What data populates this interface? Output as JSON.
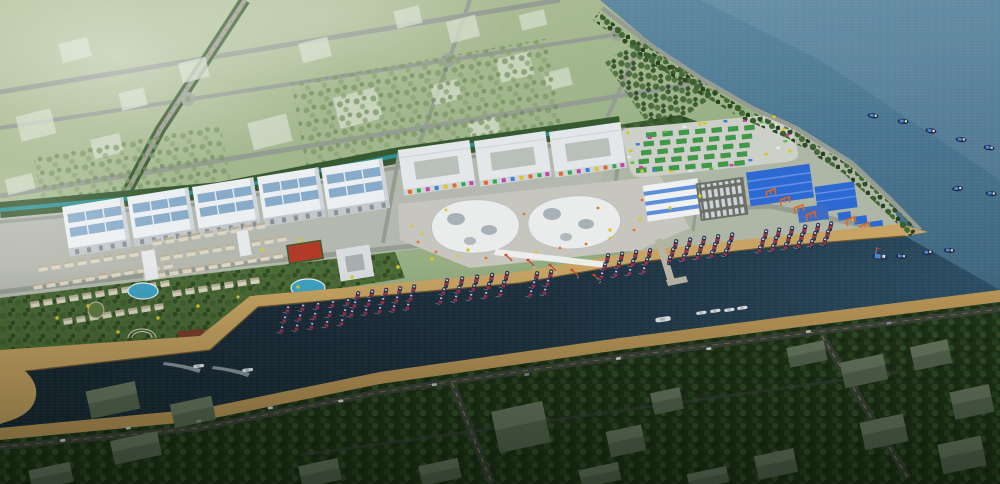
{
  "scene": {
    "description": "Aerial architectural rendering of a coastal fishing-port masterplan: pale green field blocks with grid roads upper-left, a waterfront development strip (white warehouses, white flat commercial blocks, two organic white membrane halls, a pale market lot with green stalls, blue-roofed market sheds with orange gantry cranes, a villa resort with pools), a dark harbor channel lined with tan quays and clusters of moored fishing boats, open steel-blue sea upper-right with scattered fishing boats, and a dark tree-filled district across the channel at the bottom."
  },
  "palette": {
    "sea1": "#6590a6",
    "sea2": "#4a7590",
    "sea3": "#3a6076",
    "chan1": "#141f29",
    "chan2": "#1c2f3c",
    "chan3": "#2c4f66",
    "quay": "#c7a463",
    "beach": "#bf9a5a",
    "wall": "#7c6136",
    "field1": "#b7c49e",
    "field2": "#93aa7c",
    "forest": "#375931",
    "forestD": "#24391d",
    "ground": "#b6b9ae",
    "lawn": "#4f6c38",
    "road": "#959d93",
    "roadD": "#3d453f",
    "warehouse": "#eceff1",
    "skylight": "#88abc9",
    "memb": "#e9eceb",
    "patch": "#98a3ab",
    "plaza": "#c7c6be",
    "shed": "#2d69d3",
    "shedL": "#648fe2",
    "flatB": "#3b6cc6",
    "orange": "#e0661f",
    "red": "#c64a2a",
    "pool": "#3fa3c4",
    "court": "#b23a28",
    "hull": "#252f4e",
    "boatR": "#9c3346",
    "tarp": "#4b84d4",
    "carW": "#e4e6e7",
    "dashY": "#c9a43e",
    "canal": "#2e8f90",
    "bushY": "#d6c92f",
    "villa": "#dcd6c4"
  },
  "sea_boats": [
    {
      "x": 868,
      "y": 112,
      "r": 8
    },
    {
      "x": 898,
      "y": 118,
      "r": 5
    },
    {
      "x": 926,
      "y": 127,
      "r": 10
    },
    {
      "x": 956,
      "y": 136,
      "r": 6
    },
    {
      "x": 984,
      "y": 144,
      "r": 8
    },
    {
      "x": 952,
      "y": 186,
      "r": -4
    },
    {
      "x": 986,
      "y": 190,
      "r": 6
    },
    {
      "x": 896,
      "y": 253,
      "r": 4
    },
    {
      "x": 922,
      "y": 250,
      "r": -6
    },
    {
      "x": 944,
      "y": 247,
      "r": 5
    }
  ],
  "flag_boat": {
    "x": 872,
    "y": 252
  },
  "moored_clusters": [
    {
      "x": 284,
      "y": 315,
      "rows": 3,
      "cols": 5,
      "dx": 15,
      "dy": 10
    },
    {
      "x": 354,
      "y": 301,
      "rows": 3,
      "cols": 5,
      "dx": 14,
      "dy": 9
    },
    {
      "x": 443,
      "y": 288,
      "rows": 3,
      "cols": 5,
      "dx": 15,
      "dy": 9
    },
    {
      "x": 533,
      "y": 281,
      "rows": 3,
      "cols": 2,
      "dx": 14,
      "dy": 9
    },
    {
      "x": 604,
      "y": 263,
      "rows": 3,
      "cols": 4,
      "dx": 14,
      "dy": 9
    },
    {
      "x": 672,
      "y": 249,
      "rows": 3,
      "cols": 5,
      "dx": 14,
      "dy": 8
    },
    {
      "x": 762,
      "y": 239,
      "rows": 3,
      "cols": 6,
      "dx": 13,
      "dy": 8
    }
  ],
  "white_boats": [
    {
      "x": 655,
      "y": 318,
      "s": 1.2
    },
    {
      "x": 696,
      "y": 312,
      "s": 0.8
    },
    {
      "x": 710,
      "y": 310,
      "s": 0.8
    },
    {
      "x": 724,
      "y": 309,
      "s": 0.8
    },
    {
      "x": 737,
      "y": 307,
      "s": 0.8
    }
  ],
  "wake_boats": [
    {
      "x": 197,
      "y": 366
    },
    {
      "x": 246,
      "y": 370
    }
  ],
  "quay_cranes": [
    [
      506,
      255
    ],
    [
      528,
      260
    ],
    [
      550,
      265
    ],
    [
      572,
      270
    ],
    [
      594,
      275
    ]
  ],
  "gantry_cranes": [
    [
      766,
      190
    ],
    [
      780,
      198
    ],
    [
      794,
      206
    ],
    [
      806,
      213
    ],
    [
      846,
      218
    ],
    [
      860,
      224
    ]
  ],
  "warehouses": [
    [
      62,
      207
    ],
    [
      127,
      197
    ],
    [
      192,
      187
    ],
    [
      257,
      177
    ],
    [
      321,
      168
    ]
  ],
  "comm_blocks": [
    [
      398,
      150
    ],
    [
      474,
      141
    ],
    [
      549,
      132
    ]
  ],
  "villa_rows": [
    {
      "x": 38,
      "y": 266,
      "n": 9
    },
    {
      "x": 33,
      "y": 284,
      "n": 11
    },
    {
      "x": 30,
      "y": 302,
      "n": 11
    },
    {
      "x": 63,
      "y": 319,
      "n": 8
    },
    {
      "x": 152,
      "y": 240,
      "n": 9
    },
    {
      "x": 147,
      "y": 257,
      "n": 11
    },
    {
      "x": 143,
      "y": 274,
      "n": 11
    },
    {
      "x": 172,
      "y": 291,
      "n": 7
    }
  ],
  "field_buildings": [
    [
      18,
      112,
      36,
      26
    ],
    [
      92,
      136,
      30,
      20
    ],
    [
      6,
      176,
      28,
      16
    ],
    [
      120,
      90,
      26,
      18
    ],
    [
      250,
      118,
      40,
      28
    ],
    [
      336,
      92,
      44,
      32
    ],
    [
      300,
      40,
      30,
      20
    ],
    [
      395,
      8,
      26,
      18
    ],
    [
      448,
      18,
      30,
      22
    ],
    [
      498,
      55,
      34,
      24
    ],
    [
      432,
      82,
      28,
      20
    ],
    [
      520,
      12,
      26,
      16
    ],
    [
      180,
      60,
      28,
      20
    ],
    [
      60,
      40,
      30,
      20
    ],
    [
      470,
      120,
      30,
      22
    ],
    [
      545,
      70,
      26,
      18
    ]
  ],
  "south_buildings": [
    [
      88,
      386,
      50,
      28
    ],
    [
      172,
      400,
      42,
      24
    ],
    [
      112,
      436,
      48,
      24
    ],
    [
      495,
      406,
      52,
      42
    ],
    [
      420,
      462,
      40,
      20
    ],
    [
      300,
      462,
      40,
      22
    ],
    [
      608,
      428,
      36,
      26
    ],
    [
      652,
      390,
      30,
      22
    ],
    [
      788,
      344,
      38,
      20
    ],
    [
      842,
      358,
      44,
      26
    ],
    [
      912,
      343,
      38,
      24
    ],
    [
      952,
      388,
      40,
      28
    ],
    [
      862,
      418,
      44,
      28
    ],
    [
      756,
      452,
      40,
      24
    ],
    [
      580,
      466,
      40,
      18
    ],
    [
      30,
      466,
      42,
      20
    ],
    [
      940,
      440,
      44,
      30
    ],
    [
      688,
      470,
      40,
      16
    ]
  ],
  "coast_cars": [
    60,
    126,
    196,
    268,
    338,
    432,
    524,
    616,
    706,
    806,
    886
  ],
  "stall_grid": {
    "x": 646,
    "y": 133,
    "rows": 5,
    "cols": 7,
    "dx": 16.5,
    "dy": 8.6,
    "rowdx": -2.5
  },
  "lot_dots": {
    "cx": 708,
    "cy": 146,
    "rx": 80,
    "ry": 23,
    "n": 24,
    "colors": [
      "#c843a8",
      "#5abf3a",
      "#e5e8e9",
      "#d8c22e",
      "#3f7fd6"
    ]
  },
  "plaza_dots": [
    [
      412,
      226
    ],
    [
      418,
      242
    ],
    [
      436,
      252
    ],
    [
      458,
      256
    ],
    [
      486,
      258
    ],
    [
      512,
      256
    ],
    [
      536,
      252
    ],
    [
      560,
      248
    ],
    [
      586,
      244
    ],
    [
      610,
      238
    ],
    [
      634,
      230
    ],
    [
      650,
      218
    ],
    [
      446,
      210
    ],
    [
      524,
      214
    ],
    [
      598,
      208
    ],
    [
      422,
      234
    ],
    [
      642,
      200
    ],
    [
      660,
      190
    ]
  ],
  "bushes": [
    [
      57,
      318
    ],
    [
      88,
      306
    ],
    [
      118,
      332
    ],
    [
      158,
      318
    ],
    [
      198,
      306
    ],
    [
      238,
      297
    ],
    [
      298,
      287
    ],
    [
      352,
      277
    ],
    [
      398,
      267
    ],
    [
      432,
      259
    ],
    [
      468,
      250
    ],
    [
      300,
      240
    ],
    [
      262,
      250
    ],
    [
      610,
      230
    ],
    [
      640,
      219
    ],
    [
      670,
      208
    ],
    [
      700,
      196
    ],
    [
      628,
      133
    ],
    [
      700,
      124
    ],
    [
      774,
      117
    ],
    [
      790,
      151
    ],
    [
      642,
      171
    ]
  ]
}
